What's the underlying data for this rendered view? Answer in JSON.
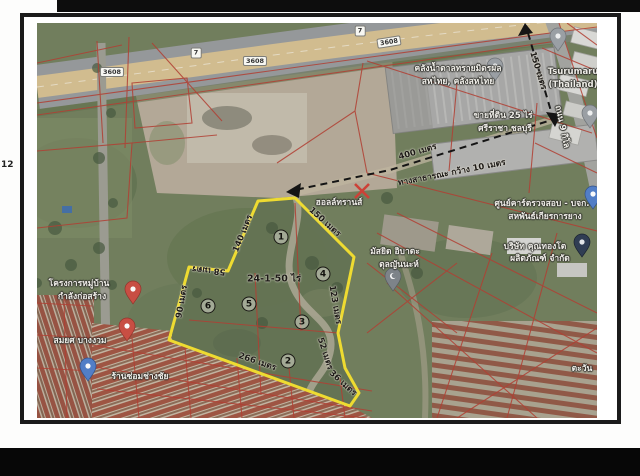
{
  "page": {
    "fragment": "12"
  },
  "map": {
    "badges": {
      "r3608_a": "3608",
      "hwy7_a": "7",
      "r3608_b": "3608",
      "hwy7_b": "7",
      "r3608_c": "3608"
    },
    "places": {
      "warehouse_line1": "คลังน้ำตาลทรายมิตรผล",
      "warehouse_line2": "สหไทย, คลังสหไทย",
      "tsurumaru_line1": "Tsurumaru",
      "tsurumaru_line2": "(Thailand)",
      "sale_line1": "ขายที่ดิน 25 ไร่",
      "sale_line2": "ศรีราชา ชลบุรี",
      "hall_trans": "ฮอลล์ทรานส์",
      "mosque_line1": "มัสยิด อิบาดะ",
      "mosque_line2": "ตุลญันนะห์",
      "inspection_line1": "ศูนย์คาร์ตรวจสอบ - บจก.",
      "inspection_line2": "สหพันธ์เกียรการยาง",
      "company_line1": "บริษัท คุณทองโต",
      "company_line2": "ผลิตภัณฑ์ จำกัด",
      "village_line1": "โครงการหมู่บ้าน",
      "village_line2": "กำลังก่อสร้าง",
      "somyot": "สมยศ บางงวม",
      "repair_shop": "ร้านซ่อมช่างชัย",
      "tawan": "ตะวัน",
      "road9": "ถนน 9 กิโล"
    },
    "measurements": {
      "m150_access": "150 เมตร",
      "m400": "400 เมตร",
      "public_way": "ทางสาธารณะ กว้าง 10 เมตร",
      "m150_edge": "150 เมตร",
      "m140": "140 เมตร",
      "m58": "58 เมตร",
      "m90": "90 เมตร",
      "m123": "123 เมตร",
      "m52": "52 เมตร",
      "m36": "36 เมตร",
      "m266": "266 เมตร",
      "area": "24-1-50 ไร่"
    },
    "plot_points": [
      "1",
      "2",
      "3",
      "4",
      "5",
      "6"
    ],
    "colors": {
      "plot_outline": "#f7e017",
      "cadastral_red": "#c0392b",
      "dash_black": "#111111"
    }
  }
}
